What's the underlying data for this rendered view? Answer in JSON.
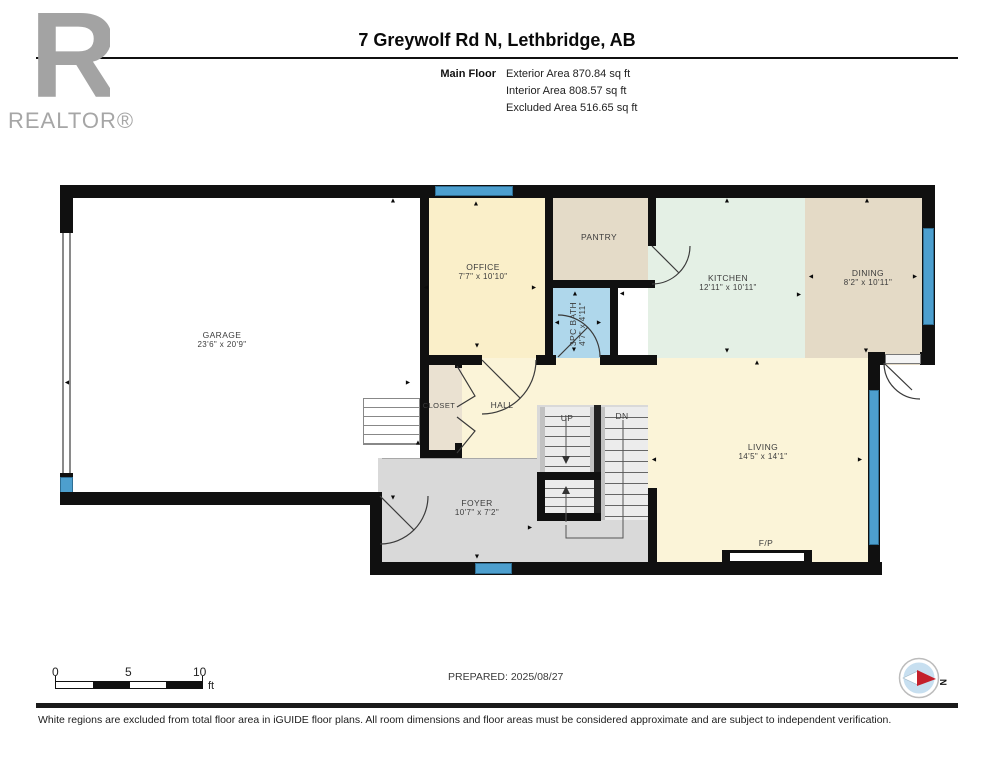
{
  "header": {
    "brand": "REALTOR®",
    "title": "7 Greywolf Rd N, Lethbridge, AB",
    "floor_label": "Main Floor",
    "areas": [
      "Exterior Area 870.84 sq ft",
      "Interior Area 808.57 sq ft",
      "Excluded Area 516.65 sq ft"
    ]
  },
  "rooms": {
    "garage": {
      "label": "GARAGE",
      "dims": "23'6\" x 20'9\""
    },
    "office": {
      "label": "OFFICE",
      "dims": "7'7\" x 10'10\""
    },
    "pantry": {
      "label": "PANTRY"
    },
    "bath": {
      "label": "3PC BATH",
      "dims": "4'7\" x 4'11\""
    },
    "kitchen": {
      "label": "KITCHEN",
      "dims": "12'11\" x 10'11\""
    },
    "dining": {
      "label": "DINING",
      "dims": "8'2\" x 10'11\""
    },
    "living": {
      "label": "LIVING",
      "dims": "14'5\" x 14'1\""
    },
    "hall": {
      "label": "HALL"
    },
    "closet": {
      "label": "CLOSET"
    },
    "foyer": {
      "label": "FOYER",
      "dims": "10'7\" x 7'2\""
    },
    "fireplace": {
      "label": "F/P"
    }
  },
  "stairs": {
    "up": "UP",
    "dn": "DN"
  },
  "plan": {
    "arrows": [
      {
        "d": "up",
        "x": 393,
        "y": 201
      },
      {
        "d": "left",
        "x": 67,
        "y": 383
      },
      {
        "d": "right",
        "x": 408,
        "y": 383
      },
      {
        "d": "down",
        "x": 393,
        "y": 498
      },
      {
        "d": "up",
        "x": 476,
        "y": 204
      },
      {
        "d": "left",
        "x": 426,
        "y": 288
      },
      {
        "d": "right",
        "x": 534,
        "y": 288
      },
      {
        "d": "down",
        "x": 477,
        "y": 346
      },
      {
        "d": "up",
        "x": 575,
        "y": 294
      },
      {
        "d": "left",
        "x": 557,
        "y": 323
      },
      {
        "d": "right",
        "x": 599,
        "y": 323
      },
      {
        "d": "down",
        "x": 574,
        "y": 350
      },
      {
        "d": "up",
        "x": 727,
        "y": 201
      },
      {
        "d": "down",
        "x": 727,
        "y": 351
      },
      {
        "d": "right",
        "x": 799,
        "y": 295
      },
      {
        "d": "left",
        "x": 622,
        "y": 294
      },
      {
        "d": "left",
        "x": 811,
        "y": 277
      },
      {
        "d": "right",
        "x": 915,
        "y": 277
      },
      {
        "d": "up",
        "x": 867,
        "y": 201
      },
      {
        "d": "down",
        "x": 866,
        "y": 351
      },
      {
        "d": "up",
        "x": 757,
        "y": 363
      },
      {
        "d": "left",
        "x": 654,
        "y": 460
      },
      {
        "d": "right",
        "x": 860,
        "y": 460
      },
      {
        "d": "up",
        "x": 418,
        "y": 443
      },
      {
        "d": "down",
        "x": 477,
        "y": 557
      },
      {
        "d": "right",
        "x": 530,
        "y": 528
      }
    ]
  },
  "scalebar": {
    "t0": "0",
    "t5": "5",
    "t10": "10",
    "unit": "ft"
  },
  "prepared": "PREPARED: 2025/08/27",
  "compass": {
    "label": "N"
  },
  "footer": {
    "disclaimer": "White regions are excluded from total floor area in iGUIDE floor plans. All room dimensions and floor areas must be considered approximate and are subject to independent verification."
  },
  "colors": {
    "wall": "#101010",
    "window": "#4d9fce",
    "garage": "#ffffff",
    "office": "#faefc9",
    "pantry": "#e4dbc8",
    "bath": "#afd7eb",
    "kitchen": "#e4f0e5",
    "dining": "#e4dac6",
    "living": "#fbf4d8",
    "closet": "#eae1d1",
    "foyer": "#d9d9d9",
    "compass_needle": "#c4202b"
  }
}
